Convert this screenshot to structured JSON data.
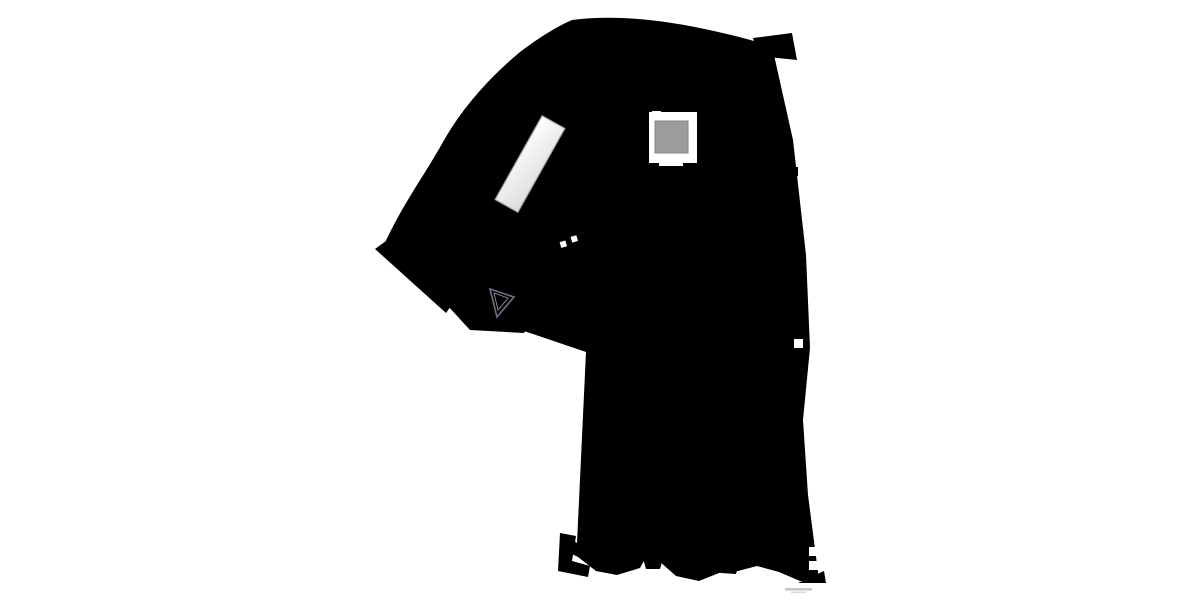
{
  "document": {
    "kind": "architectural-floorplan",
    "visible_text": "",
    "watermark_present": true
  },
  "colors": {
    "wall": "#64798b",
    "floor": "#f7eef0",
    "glass": "#b4bcc4",
    "stairline": "#a6abb2",
    "stairfill": "#fcfbfb",
    "cab": "#9c9c9c",
    "green": "#8da054",
    "darkgreen": "#4e7a3a",
    "red": "#a8323e",
    "darkred": "#7e1f2a",
    "pink": "#c94f7c",
    "yellow": "#d9c84a",
    "dark": "#3a3f44",
    "black": "#1c1f22",
    "white": "#ffffff",
    "tan": "#c8b98e",
    "olive": "#7f9344",
    "graytable": "#8496a4",
    "stool": "#9aa0a6",
    "dotcol": "#80868d"
  },
  "fixtures": [
    "glazed-facade-top",
    "glazed-facade-wing",
    "glazed-facade-bottom",
    "elevator-shaft",
    "elevator-cab",
    "spiral-staircase",
    "straight-flight",
    "winder-staircase",
    "skylight-bank",
    "watermark-text"
  ],
  "furniture": [
    {
      "name": "display-rack-top",
      "type": "merch",
      "x": 716,
      "y": 171,
      "w": 32,
      "h": 25,
      "colors": [
        "#3f4446",
        "#7f9344",
        "#b9c96a",
        "#ffffff",
        "#23272a",
        "#8a6d2f"
      ]
    },
    {
      "name": "gondola-shelf-1",
      "type": "hshelf",
      "x": 717,
      "y": 224,
      "w": 35,
      "h": 12,
      "rows": 4,
      "base": "#565a50",
      "dots": [
        "#9aa86a",
        "#ffffff",
        "#3a3f44"
      ]
    },
    {
      "name": "gondola-shelf-2",
      "type": "hshelf",
      "x": 717,
      "y": 246,
      "w": 35,
      "h": 12,
      "rows": 4,
      "base": "#565a50",
      "dots": [
        "#9aa86a",
        "#ffffff",
        "#3a3f44"
      ]
    },
    {
      "name": "lounge-area",
      "type": "lounge",
      "x": 705,
      "y": 274
    },
    {
      "name": "wall-shelf-right-1",
      "type": "vshelf",
      "x": 797,
      "y": 262,
      "w": 9,
      "h": 28,
      "rot": 2,
      "colors": [
        "#6b5b44",
        "#3c3c38",
        "#c8b98e",
        "#8a6d2f"
      ]
    },
    {
      "name": "wall-shelf-right-2",
      "type": "vshelf",
      "x": 797,
      "y": 299,
      "w": 9,
      "h": 17,
      "rot": 2,
      "colors": [
        "#3c3c38",
        "#c8b98e",
        "#6b5b44"
      ]
    },
    {
      "name": "display-cluster-1",
      "type": "merch",
      "x": 650,
      "y": 366,
      "w": 26,
      "h": 25,
      "colors": [
        "#3a3f44",
        "#a8323e",
        "#ffffff",
        "#1c1f22",
        "#7e1f2a"
      ]
    },
    {
      "name": "apparel-rack",
      "type": "rackrow",
      "x": 712,
      "y": 364,
      "w": 34,
      "h": 16,
      "cells": [
        "#8c1f2c",
        "#d04848",
        "#c94f7c",
        "#7f9344",
        "#d9c84a",
        "#1c1f22",
        "#ffffff",
        "#a8323e",
        "#356b2f",
        "#e09bb0",
        "#3a3f44",
        "#b23a48"
      ]
    },
    {
      "name": "gray-table",
      "type": "rect",
      "x": 648,
      "y": 401,
      "w": 30,
      "h": 10,
      "fill": "#8496a4"
    },
    {
      "name": "round-rack-1",
      "type": "roundrack",
      "cx": 767,
      "cy": 408,
      "r": 13
    },
    {
      "name": "small-table-1",
      "type": "smalltable",
      "x": 658,
      "y": 432,
      "w": 20,
      "h": 11,
      "rot": -6
    },
    {
      "name": "small-table-2",
      "type": "smalltable",
      "x": 717,
      "y": 429,
      "w": 20,
      "h": 11,
      "rot": -5
    },
    {
      "name": "small-table-3",
      "type": "smalltable",
      "x": 658,
      "y": 447,
      "w": 20,
      "h": 11,
      "rot": 5
    },
    {
      "name": "small-table-4",
      "type": "smalltable",
      "x": 715,
      "y": 446,
      "w": 20,
      "h": 11,
      "rot": -5
    },
    {
      "name": "wall-shelf-left-1",
      "type": "vshelf",
      "x": 584,
      "y": 420,
      "w": 12,
      "h": 10,
      "rot": 20,
      "colors": [
        "#3c3c38",
        "#c8b98e"
      ]
    },
    {
      "name": "wall-shelf-left-2",
      "type": "vshelf",
      "x": 580,
      "y": 442,
      "w": 10,
      "h": 25,
      "rot": 6,
      "colors": [
        "#6b5b44",
        "#c8b98e",
        "#3c3c38"
      ]
    },
    {
      "name": "wall-display-red",
      "type": "merch",
      "x": 576,
      "y": 480,
      "w": 16,
      "h": 23,
      "colors": [
        "#a8323e",
        "#3a3f44",
        "#ffffff",
        "#7e1f2a"
      ]
    },
    {
      "name": "display-cluster-2",
      "type": "merch",
      "x": 606,
      "y": 502,
      "w": 29,
      "h": 28,
      "colors": [
        "#a8323e",
        "#3a3f44",
        "#ffffff",
        "#d9c84a",
        "#1c1f22"
      ]
    },
    {
      "name": "round-rack-2",
      "type": "roundrack",
      "cx": 694,
      "cy": 521,
      "r": 14
    },
    {
      "name": "gondola-shelf-3",
      "type": "hshelf",
      "x": 731,
      "y": 502,
      "w": 29,
      "h": 9,
      "rows": 3,
      "base": "#565a50",
      "dots": [
        "#9aa86a",
        "#ffffff"
      ]
    },
    {
      "name": "gondola-shelf-4",
      "type": "hshelf",
      "x": 731,
      "y": 527,
      "w": 29,
      "h": 9,
      "rows": 3,
      "base": "#565a50",
      "dots": [
        "#9aa86a",
        "#ffffff"
      ]
    },
    {
      "name": "wall-shelf-right-3",
      "type": "vshelf",
      "x": 793,
      "y": 506,
      "w": 17,
      "h": 11,
      "rot": 0,
      "colors": [
        "#c8b98e",
        "#7f9344",
        "#3c3c38"
      ]
    },
    {
      "name": "wall-shelf-right-4",
      "type": "vshelf",
      "x": 793,
      "y": 519,
      "w": 17,
      "h": 12,
      "rot": 0,
      "colors": [
        "#3c3c38",
        "#c8b98e",
        "#7f9344"
      ]
    },
    {
      "name": "plant-1",
      "type": "plant",
      "cx": 595,
      "cy": 559,
      "r": 5
    },
    {
      "name": "plant-2",
      "type": "plant",
      "cx": 627,
      "cy": 556,
      "r": 7
    },
    {
      "name": "stool-1",
      "type": "donut",
      "cx": 613,
      "cy": 565,
      "r": 4,
      "fill": "#9aa0a6"
    },
    {
      "name": "stool-2",
      "type": "donut",
      "cx": 687,
      "cy": 566,
      "r": 4,
      "fill": "#9aa0a6"
    },
    {
      "name": "stool-3",
      "type": "donut",
      "cx": 698,
      "cy": 563,
      "r": 4,
      "fill": "#b9b0a4"
    },
    {
      "name": "seat-gray",
      "type": "donut",
      "cx": 760,
      "cy": 565,
      "r": 5,
      "fill": "#8d949b"
    },
    {
      "name": "seat-red",
      "type": "donut",
      "cx": 773,
      "cy": 567,
      "r": 5,
      "fill": "#a8323e"
    },
    {
      "name": "seat-dark",
      "type": "wedge",
      "cx": 786,
      "cy": 569,
      "r": 6,
      "fill": "#3a3f44"
    },
    {
      "name": "ladder-shelf",
      "type": "ladder",
      "x": 617,
      "y": 167,
      "w": 15,
      "h": 23,
      "rot": -20
    },
    {
      "name": "column-square-1",
      "type": "column",
      "x": 720,
      "y": 111,
      "w": 10,
      "h": 10
    },
    {
      "name": "column-square-2",
      "type": "column",
      "x": 621,
      "y": 236,
      "w": 13,
      "h": 12,
      "dots": true
    },
    {
      "name": "column-square-3",
      "type": "column",
      "x": 646,
      "y": 470,
      "w": 9,
      "h": 9
    },
    {
      "name": "column-square-4",
      "type": "column",
      "x": 724,
      "y": 468,
      "w": 9,
      "h": 9
    },
    {
      "name": "wall-stub-below-elevator",
      "type": "column",
      "x": 642,
      "y": 184,
      "w": 14,
      "h": 9
    },
    {
      "name": "column-dot-1",
      "type": "dot",
      "cx": 587,
      "cy": 156
    },
    {
      "name": "column-dot-2",
      "type": "dot",
      "cx": 571,
      "cy": 174
    },
    {
      "name": "column-dot-3",
      "type": "dot",
      "cx": 555,
      "cy": 192
    }
  ]
}
